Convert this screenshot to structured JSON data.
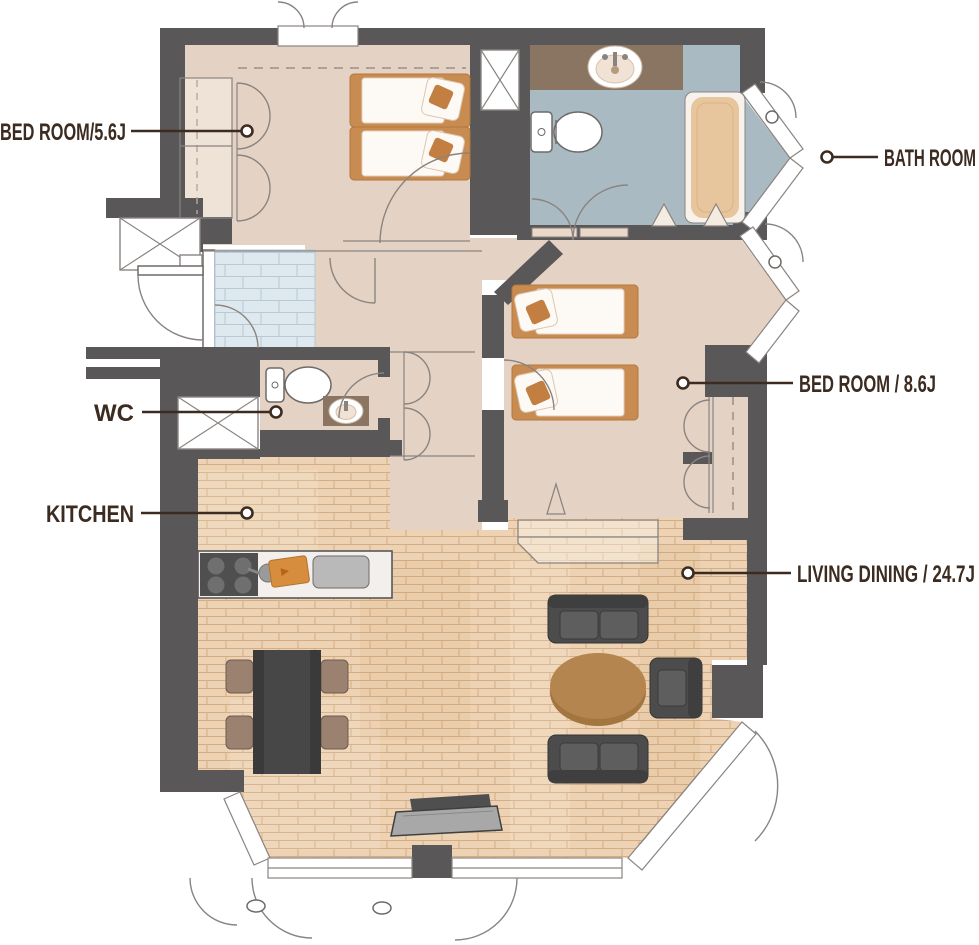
{
  "labels": {
    "bedroom1": "BED ROOM/5.6J",
    "bathroom": "BATH ROOM",
    "bedroom2": "BED ROOM / 8.6J",
    "wc": "WC",
    "kitchen": "KITCHEN",
    "living": "LIVING DINING / 24.7J"
  },
  "colors": {
    "wall": "#595757",
    "floor_tan": "#e4d3c5",
    "floor_light": "#efe3d7",
    "bath_floor": "#a9bac3",
    "vanity_brown": "#8a7462",
    "tub_tan": "#e7c69e",
    "wood": "#edd3b3",
    "wood_line": "#d4ad84",
    "tile_blue": "#dde9ee",
    "bed_orange": "#c88c52",
    "pillow_orange": "#c27f41",
    "sofa_dark": "#4c4c4c",
    "chair_brown": "#9b8170",
    "table_wood": "#b5854f",
    "label_color": "#3b2b20"
  }
}
